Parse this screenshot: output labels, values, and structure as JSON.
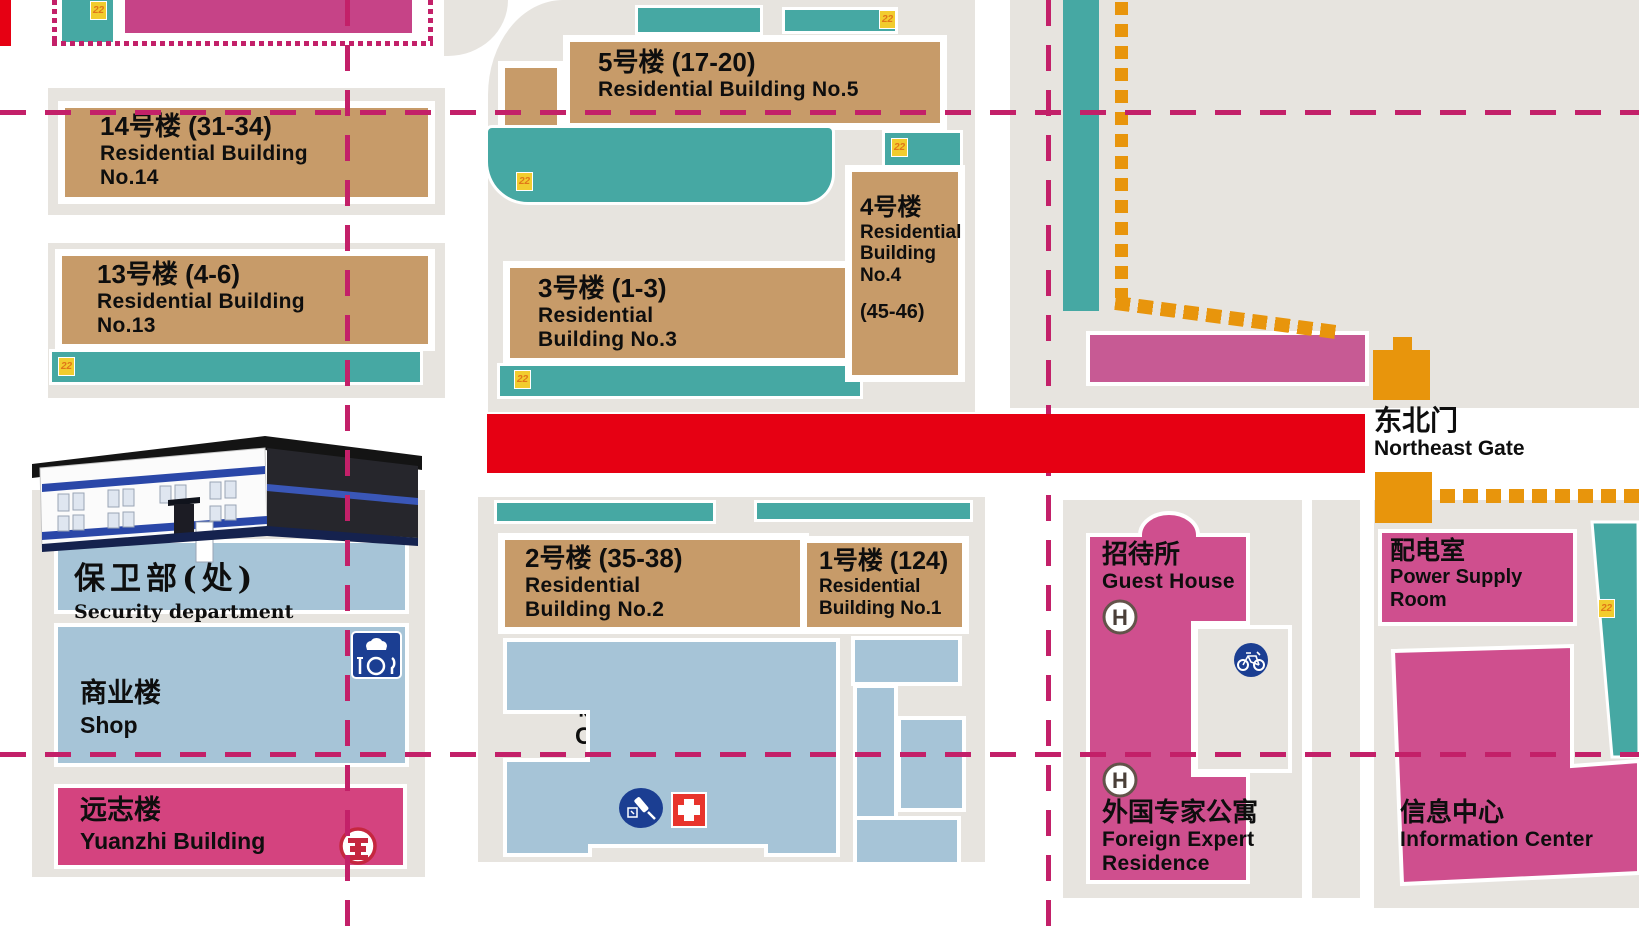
{
  "buildings": {
    "no14": {
      "zh": "14号楼 (31-34)",
      "en": [
        "Residential Building",
        "No.14"
      ]
    },
    "no13": {
      "zh": "13号楼 (4-6)",
      "en": [
        "Residential Building",
        "No.13"
      ]
    },
    "no5": {
      "zh": "5号楼 (17-20)",
      "en": [
        "Residential Building No.5"
      ]
    },
    "no3": {
      "zh": "3号楼 (1-3)",
      "en": [
        "Residential",
        "Building No.3"
      ]
    },
    "no4": {
      "zh": "4号楼",
      "en": [
        "Residential",
        "Building",
        "No.4"
      ],
      "units": "(45-46)"
    },
    "no2": {
      "zh": "2号楼 (35-38)",
      "en": [
        "Residential",
        "Building No.2"
      ]
    },
    "no1": {
      "zh": "1号楼 (124)",
      "en": [
        "Residential",
        "Building No.1"
      ]
    },
    "security": {
      "zh": "保卫部(处)",
      "en": "Security department"
    },
    "shop": {
      "zh": "商业楼",
      "en": "Shop"
    },
    "yuanzhi": {
      "zh": "远志楼",
      "en": "Yuanzhi Building"
    },
    "clinic": {
      "zh": "校医院",
      "en": "Clinic"
    },
    "guest_house": {
      "zh": "招待所",
      "en": "Guest House"
    },
    "foreign_expert": {
      "zh": "外国专家公寓",
      "en": [
        "Foreign Expert",
        "Residence"
      ]
    },
    "power_supply": {
      "zh": "配电室",
      "en": [
        "Power Supply",
        "Room"
      ]
    },
    "info_center": {
      "zh": "信息中心",
      "en": "Information Center"
    }
  },
  "gate": {
    "zh": "东北门",
    "en": "Northeast Gate"
  },
  "markers": {
    "shed_tag": "22",
    "hotel_mark": "H"
  },
  "icons": {
    "restaurant": "chef-hat-plate-and-cutlery",
    "hotel": "letter-H-in-circle",
    "bicycle": "white-bicycle-in-blue-circle",
    "medical": "syringe-in-blue-ellipse",
    "first_aid": "white-cross-on-red-square",
    "bank": "icbc-bank-emblem",
    "shed": "yellow-22-tag"
  },
  "colors": {
    "parcel": "#e7e4df",
    "residential_block": "#c79b69",
    "public_building": "#cf4f8e",
    "service_building": "#a6c4d7",
    "shed_strip": "#46a8a3",
    "road_dash_line": "#c32069",
    "walk_path_dots": "#e8950c",
    "highlighted_road": "#e60013"
  }
}
